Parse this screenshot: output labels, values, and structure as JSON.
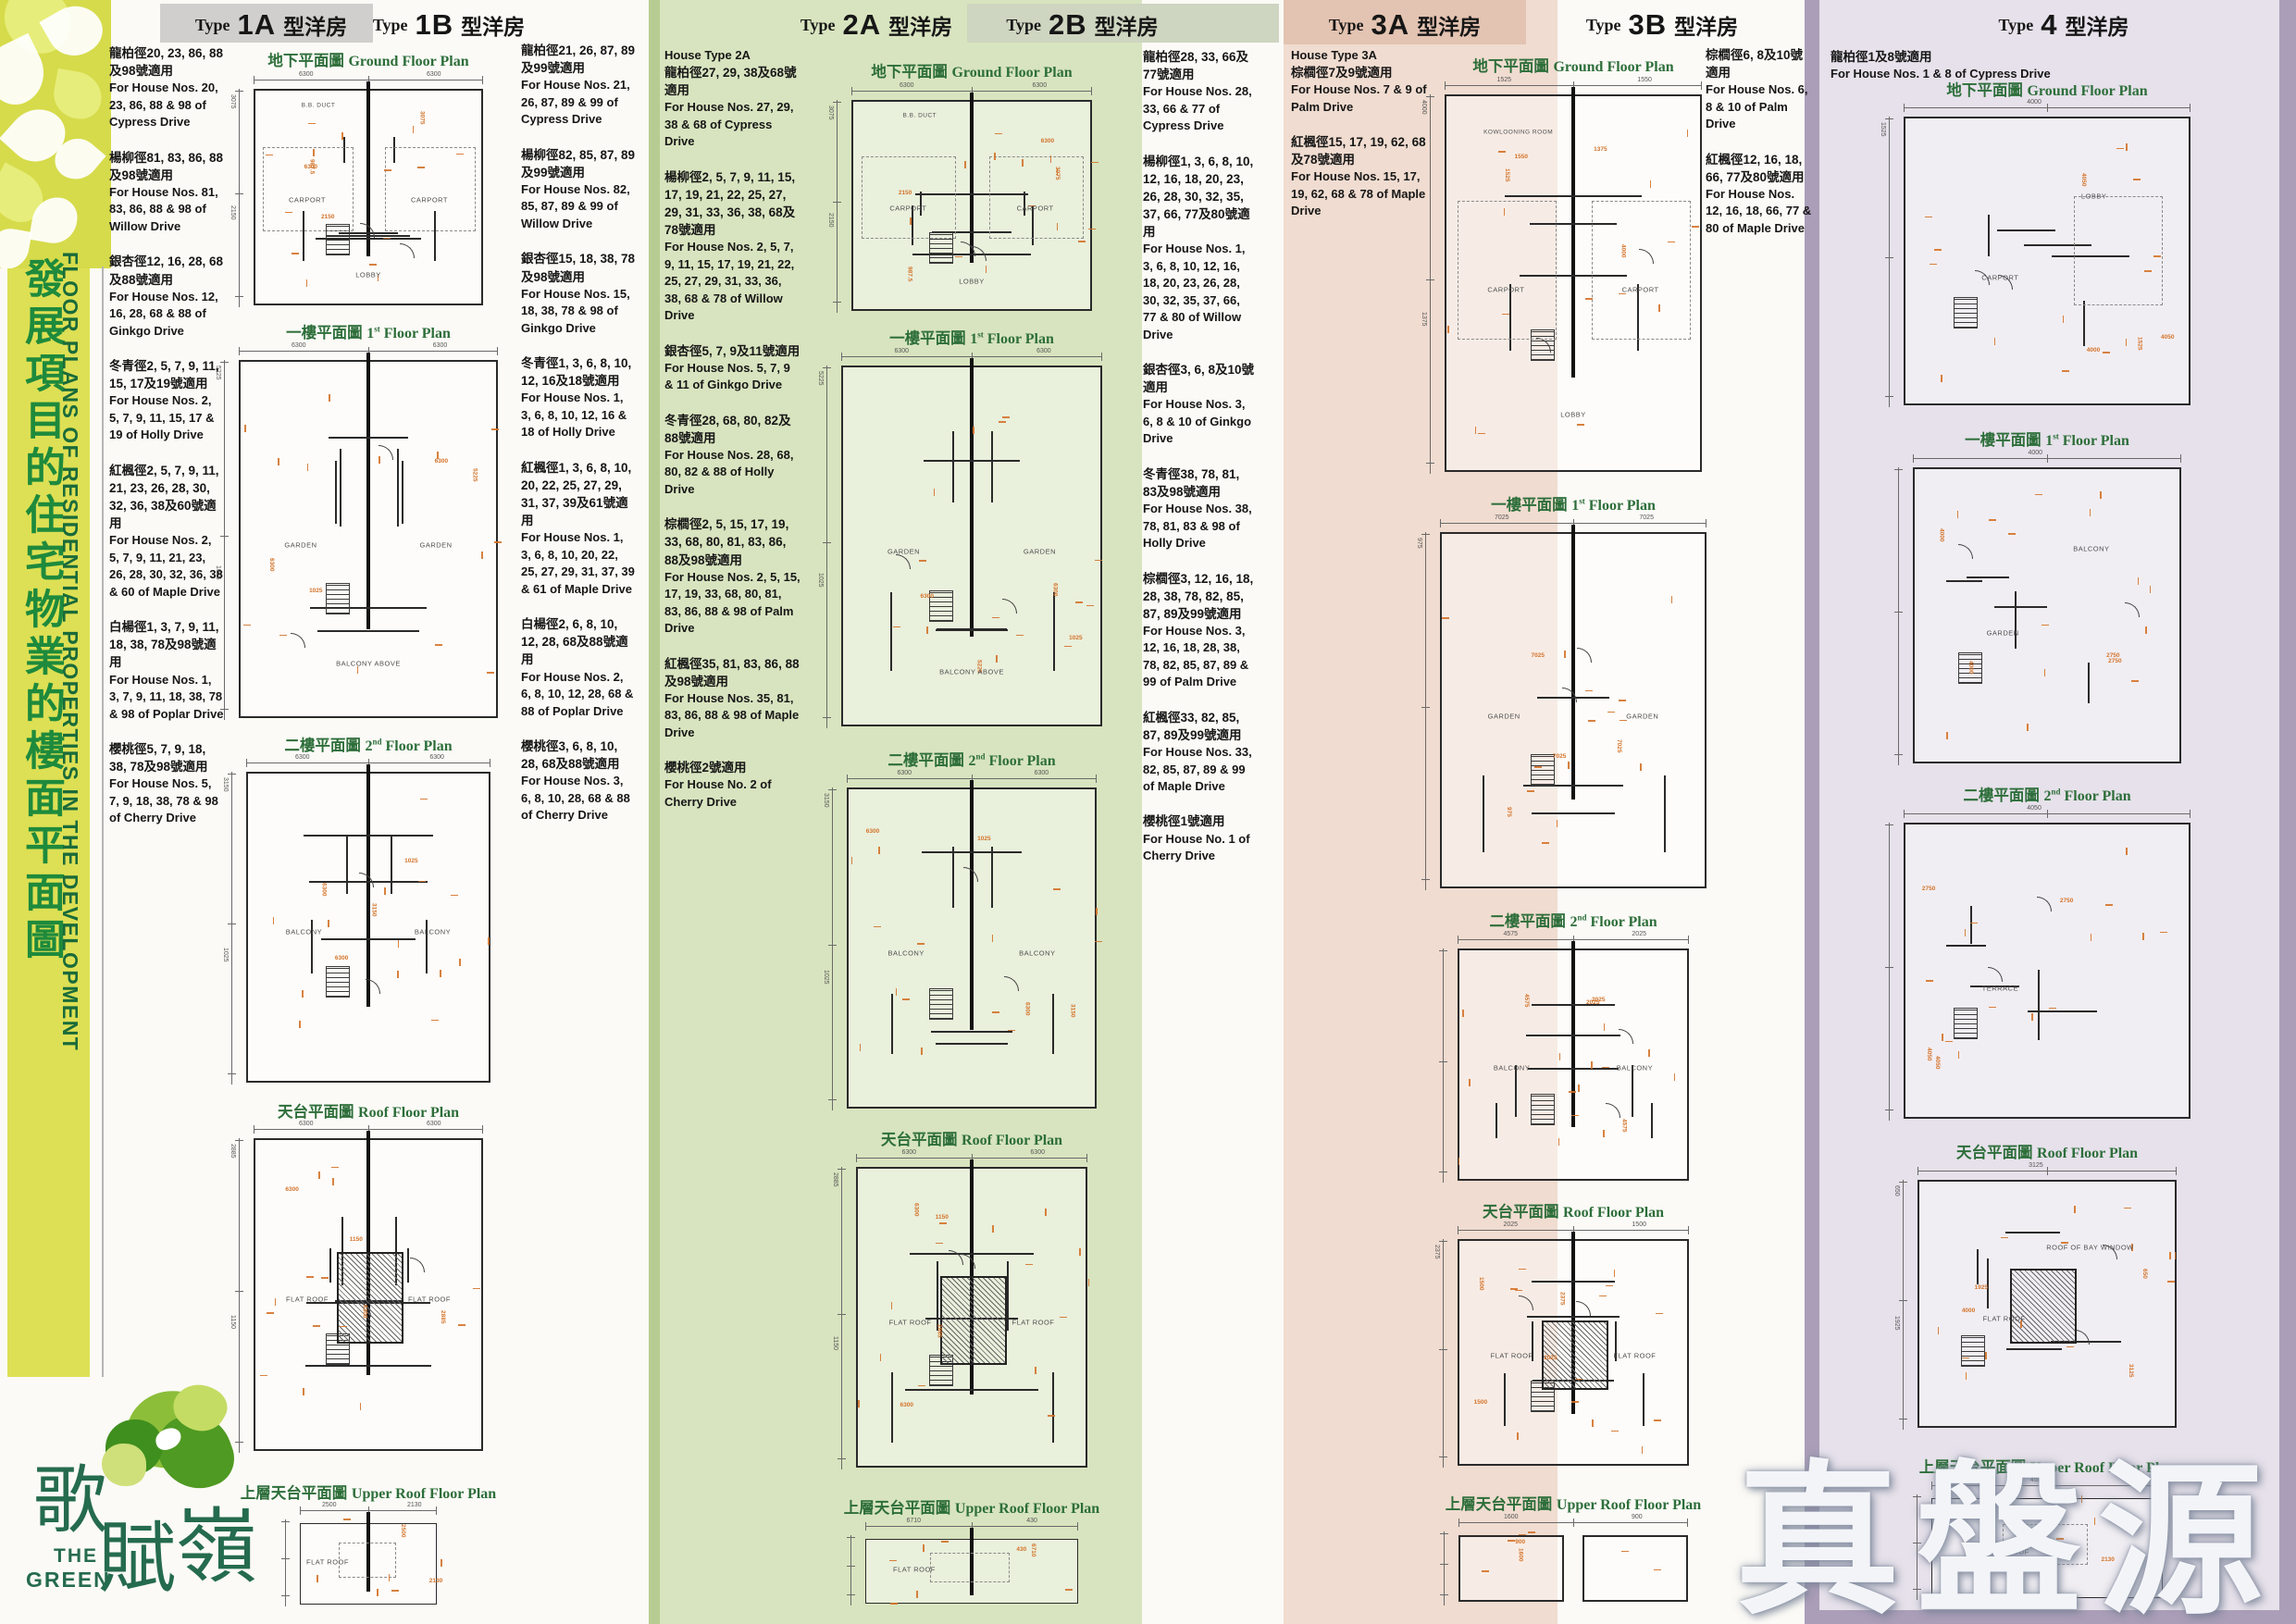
{
  "sidebar": {
    "title_zh": "發展項目的住宅物業的樓面平面圖",
    "title_en": "FLOOR PLANS OF RESIDENTIAL PROPERTIES IN THE DEVELOPMENT",
    "logo": {
      "name_zh": "歌賦嶺",
      "en_line1": "THE",
      "en_line2": "GREEN"
    }
  },
  "watermark": "真盤源",
  "colors": {
    "sidebar_yellow": "#dde054",
    "band_green": "#d8e4bf",
    "band_pink": "#f0dcd0",
    "band_lavender": "#e6e1ea",
    "header_gray": "#d0cfcd",
    "header_pink": "#e3c3b1",
    "header_sage": "#ced5c0",
    "title_green": "#2d6e3a",
    "sidebar_text_green": "#1e8a3c",
    "dimension_orange": "#d4732a",
    "plan_line": "#2a2a2a",
    "logo_teal": "#256b4e"
  },
  "groups": [
    {
      "id": "1",
      "headers": [
        {
          "type_word": "Type",
          "code": "1A",
          "suffix_zh": "型洋房"
        },
        {
          "type_word": "Type",
          "code": "1B",
          "suffix_zh": "型洋房"
        }
      ],
      "left_heading": "",
      "left_notes": [
        {
          "zh": "龍柏徑20, 23, 86, 88及98號適用",
          "en": "For House Nos. 20, 23, 86, 88 & 98 of Cypress Drive"
        },
        {
          "zh": "楊柳徑81, 83, 86, 88及98號適用",
          "en": "For House Nos. 81, 83, 86, 88 & 98 of Willow Drive"
        },
        {
          "zh": "銀杏徑12, 16, 28, 68及88號適用",
          "en": "For House Nos. 12, 16, 28, 68 & 88 of Ginkgo Drive"
        },
        {
          "zh": "冬青徑2, 5, 7, 9, 11, 15, 17及19號適用",
          "en": "For House Nos. 2, 5, 7, 9, 11, 15, 17 & 19 of Holly Drive"
        },
        {
          "zh": "紅楓徑2, 5, 7, 9, 11, 21, 23, 26, 28, 30, 32, 36, 38及60號適用",
          "en": "For House Nos. 2, 5, 7, 9, 11, 21, 23, 26, 28, 30, 32, 36, 38 & 60 of Maple Drive"
        },
        {
          "zh": "白楊徑1, 3, 7, 9, 11, 18, 38, 78及98號適用",
          "en": "For House Nos. 1, 3, 7, 9, 11, 18, 38, 78 & 98 of Poplar Drive"
        },
        {
          "zh": "櫻桃徑5, 7, 9, 18, 38, 78及98號適用",
          "en": "For House Nos. 5, 7, 9, 18, 38, 78 & 98 of Cherry Drive"
        }
      ],
      "right_heading": "",
      "right_notes": [
        {
          "zh": "龍柏徑21, 26, 87, 89及99號適用",
          "en": "For House Nos. 21, 26, 87, 89 & 99 of Cypress Drive"
        },
        {
          "zh": "楊柳徑82, 85, 87, 89及99號適用",
          "en": "For House Nos. 82, 85, 87, 89 & 99 of Willow Drive"
        },
        {
          "zh": "銀杏徑15, 18, 38, 78及98號適用",
          "en": "For House Nos. 15, 18, 38, 78 & 98 of Ginkgo Drive"
        },
        {
          "zh": "冬青徑1, 3, 6, 8, 10, 12, 16及18號適用",
          "en": "For House Nos. 1, 3, 6, 8, 10, 12, 16 & 18 of Holly Drive"
        },
        {
          "zh": "紅楓徑1, 3, 6, 8, 10, 20, 22, 25, 27, 29, 31, 37, 39及61號適用",
          "en": "For House Nos. 1, 3, 6, 8, 10, 20, 22, 25, 27, 29, 31, 37, 39 & 61 of Maple Drive"
        },
        {
          "zh": "白楊徑2, 6, 8, 10, 12, 28, 68及88號適用",
          "en": "For House Nos. 2, 6, 8, 10, 12, 28, 68 & 88 of Poplar Drive"
        },
        {
          "zh": "櫻桃徑3, 6, 8, 10, 28, 68及88號適用",
          "en": "For House Nos. 3, 6, 8, 10, 28, 68 & 88 of Cherry Drive"
        }
      ],
      "floors": [
        {
          "zh": "地下平面圖",
          "en": "Ground Floor Plan",
          "labels": [
            "CARPORT",
            "CARPORT",
            "LOBBY",
            "B.B. DUCT"
          ],
          "dims": [
            "6300",
            "6300",
            "3075",
            "2150",
            "987.5"
          ]
        },
        {
          "zh": "一樓平面圖",
          "en": "1st Floor Plan",
          "labels": [
            "GARDEN",
            "GARDEN",
            "BALCONY ABOVE"
          ],
          "dims": [
            "6300",
            "6300",
            "5225",
            "1025"
          ]
        },
        {
          "zh": "二樓平面圖",
          "en": "2nd Floor Plan",
          "labels": [
            "BALCONY",
            "BALCONY"
          ],
          "dims": [
            "6300",
            "6300",
            "3150",
            "1025"
          ]
        },
        {
          "zh": "天台平面圖",
          "en": "Roof Floor Plan",
          "labels": [
            "FLAT ROOF",
            "FLAT ROOF"
          ],
          "dims": [
            "6300",
            "6300",
            "2885",
            "1150"
          ]
        },
        {
          "zh": "上層天台平面圖",
          "en": "Upper Roof Floor Plan",
          "labels": [
            "FLAT ROOF"
          ],
          "dims": [
            "2500",
            "2130"
          ]
        }
      ]
    },
    {
      "id": "2",
      "headers": [
        {
          "type_word": "Type",
          "code": "2A",
          "suffix_zh": "型洋房"
        },
        {
          "type_word": "Type",
          "code": "2B",
          "suffix_zh": "型洋房"
        }
      ],
      "left_heading": "House Type 2A",
      "left_notes": [
        {
          "zh": "龍柏徑27, 29, 38及68號適用",
          "en": "For House Nos. 27, 29, 38 & 68 of Cypress Drive"
        },
        {
          "zh": "楊柳徑2, 5, 7, 9, 11, 15, 17, 19, 21, 22, 25, 27, 29, 31, 33, 36, 38, 68及78號適用",
          "en": "For House Nos. 2, 5, 7, 9, 11, 15, 17, 19, 21, 22, 25, 27, 29, 31, 33, 36, 38, 68 & 78 of Willow Drive"
        },
        {
          "zh": "銀杏徑5, 7, 9及11號適用",
          "en": "For House Nos. 5, 7, 9 & 11 of Ginkgo Drive"
        },
        {
          "zh": "冬青徑28, 68, 80, 82及88號適用",
          "en": "For House Nos. 28, 68, 80, 82 & 88 of Holly Drive"
        },
        {
          "zh": "棕櫚徑2, 5, 15, 17, 19, 33, 68, 80, 81, 83, 86, 88及98號適用",
          "en": "For House Nos. 2, 5, 15, 17, 19, 33, 68, 80, 81, 83, 86, 88 & 98 of Palm Drive"
        },
        {
          "zh": "紅楓徑35, 81, 83, 86, 88及98號適用",
          "en": "For House Nos. 35, 81, 83, 86, 88 & 98 of Maple Drive"
        },
        {
          "zh": "櫻桃徑2號適用",
          "en": "For House No. 2 of Cherry Drive"
        }
      ],
      "right_heading": "",
      "right_notes": [
        {
          "zh": "龍柏徑28, 33, 66及77號適用",
          "en": "For House Nos. 28, 33, 66 & 77 of Cypress Drive"
        },
        {
          "zh": "楊柳徑1, 3, 6, 8, 10, 12, 16, 18, 20, 23, 26, 28, 30, 32, 35, 37, 66, 77及80號適用",
          "en": "For House Nos. 1, 3, 6, 8, 10, 12, 16, 18, 20, 23, 26, 28, 30, 32, 35, 37, 66, 77 & 80 of Willow Drive"
        },
        {
          "zh": "銀杏徑3, 6, 8及10號適用",
          "en": "For House Nos. 3, 6, 8 & 10 of Ginkgo Drive"
        },
        {
          "zh": "冬青徑38, 78, 81, 83及98號適用",
          "en": "For House Nos. 38, 78, 81, 83 & 98 of Holly Drive"
        },
        {
          "zh": "棕櫚徑3, 12, 16, 18, 28, 38, 78, 82, 85, 87, 89及99號適用",
          "en": "For House Nos. 3, 12, 16, 18, 28, 38, 78, 82, 85, 87, 89 & 99 of Palm Drive"
        },
        {
          "zh": "紅楓徑33, 82, 85, 87, 89及99號適用",
          "en": "For House Nos. 33, 82, 85, 87, 89 & 99 of Maple Drive"
        },
        {
          "zh": "櫻桃徑1號適用",
          "en": "For House No. 1 of Cherry Drive"
        }
      ],
      "floors": [
        {
          "zh": "地下平面圖",
          "en": "Ground Floor Plan",
          "labels": [
            "CARPORT",
            "CARPORT",
            "LOBBY",
            "B.B. DUCT"
          ],
          "dims": [
            "6300",
            "6300",
            "3075",
            "2150",
            "987.5"
          ]
        },
        {
          "zh": "一樓平面圖",
          "en": "1st Floor Plan",
          "labels": [
            "GARDEN",
            "GARDEN",
            "BALCONY ABOVE"
          ],
          "dims": [
            "6300",
            "6300",
            "5225",
            "1025"
          ]
        },
        {
          "zh": "二樓平面圖",
          "en": "2nd Floor Plan",
          "labels": [
            "BALCONY",
            "BALCONY"
          ],
          "dims": [
            "6300",
            "6300",
            "3150",
            "1025"
          ]
        },
        {
          "zh": "天台平面圖",
          "en": "Roof Floor Plan",
          "labels": [
            "FLAT ROOF",
            "FLAT ROOF"
          ],
          "dims": [
            "6300",
            "6300",
            "2885",
            "1150"
          ]
        },
        {
          "zh": "上層天台平面圖",
          "en": "Upper Roof Floor Plan",
          "labels": [
            "FLAT ROOF"
          ],
          "dims": [
            "6710",
            "430"
          ]
        }
      ]
    },
    {
      "id": "3",
      "headers": [
        {
          "type_word": "Type",
          "code": "3A",
          "suffix_zh": "型洋房"
        },
        {
          "type_word": "Type",
          "code": "3B",
          "suffix_zh": "型洋房"
        }
      ],
      "left_heading": "House Type 3A",
      "left_notes": [
        {
          "zh": "棕櫚徑7及9號適用",
          "en": "For House Nos. 7 & 9 of Palm Drive"
        },
        {
          "zh": "紅楓徑15, 17, 19, 62, 68及78號適用",
          "en": "For House Nos. 15, 17, 19, 62, 68 & 78 of Maple Drive"
        }
      ],
      "right_heading": "",
      "right_notes": [
        {
          "zh": "棕櫚徑6, 8及10號適用",
          "en": "For House Nos. 6, 8 & 10 of Palm Drive"
        },
        {
          "zh": "紅楓徑12, 16, 18, 66, 77及80號適用",
          "en": "For House Nos. 12, 16, 18, 66, 77 & 80 of Maple Drive"
        }
      ],
      "floors": [
        {
          "zh": "地下平面圖",
          "en": "Ground Floor Plan",
          "labels": [
            "CARPORT",
            "CARPORT",
            "LOBBY",
            "KOWLOONING ROOM"
          ],
          "dims": [
            "1525",
            "1550",
            "4000",
            "1375"
          ]
        },
        {
          "zh": "一樓平面圖",
          "en": "1st Floor Plan",
          "labels": [
            "GARDEN",
            "GARDEN"
          ],
          "dims": [
            "7025",
            "7025",
            "975"
          ]
        },
        {
          "zh": "二樓平面圖",
          "en": "2nd Floor Plan",
          "labels": [
            "BALCONY",
            "BALCONY"
          ],
          "dims": [
            "4575",
            "2025"
          ]
        },
        {
          "zh": "天台平面圖",
          "en": "Roof Floor Plan",
          "labels": [
            "FLAT ROOF",
            "FLAT ROOF"
          ],
          "dims": [
            "2025",
            "1500",
            "2375"
          ]
        },
        {
          "zh": "上層天台平面圖",
          "en": "Upper Roof Floor Plan",
          "labels": [],
          "dims": [
            "1600",
            "900"
          ]
        }
      ]
    },
    {
      "id": "4",
      "headers": [
        {
          "type_word": "Type",
          "code": "4",
          "suffix_zh": "型洋房"
        }
      ],
      "left_heading": "",
      "left_notes": [
        {
          "zh": "龍柏徑1及8號適用",
          "en": "For House Nos. 1 & 8 of Cypress Drive"
        }
      ],
      "right_heading": "",
      "right_notes": [],
      "floors": [
        {
          "zh": "地下平面圖",
          "en": "Ground Floor Plan",
          "labels": [
            "CARPORT",
            "LOBBY"
          ],
          "dims": [
            "4000",
            "4050",
            "1525"
          ]
        },
        {
          "zh": "一樓平面圖",
          "en": "1st Floor Plan",
          "labels": [
            "GARDEN",
            "BALCONY"
          ],
          "dims": [
            "4000",
            "2750"
          ]
        },
        {
          "zh": "二樓平面圖",
          "en": "2nd Floor Plan",
          "labels": [
            "TERRACE"
          ],
          "dims": [
            "4050",
            "2750"
          ]
        },
        {
          "zh": "天台平面圖",
          "en": "Roof Floor Plan",
          "labels": [
            "FLAT ROOF",
            "ROOF OF BAY WINDOW"
          ],
          "dims": [
            "3125",
            "4000",
            "650",
            "1925"
          ]
        },
        {
          "zh": "上層天台平面圖",
          "en": "Upper Roof Floor Plan",
          "labels": [
            "FLAT ROOF"
          ],
          "dims": [
            "4500",
            "2130"
          ]
        }
      ]
    }
  ]
}
